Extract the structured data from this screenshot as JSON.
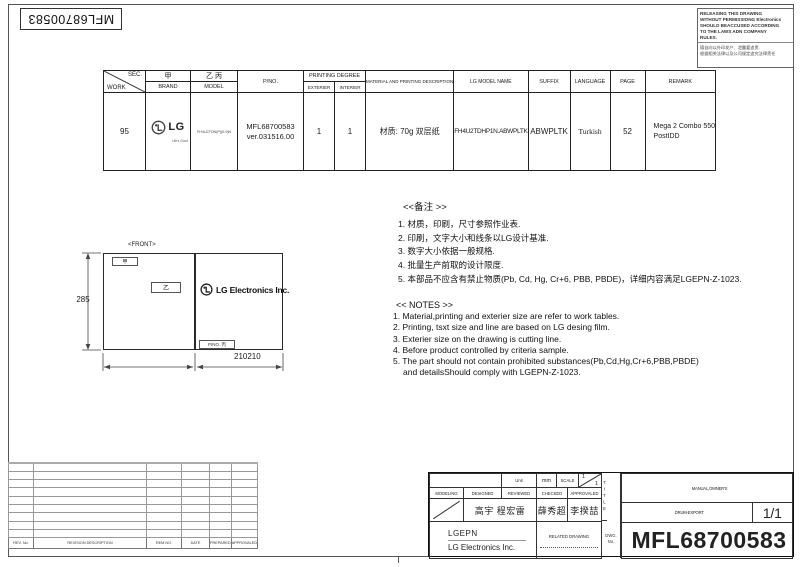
{
  "corner": {
    "rotated_part_no": "MFL68700583"
  },
  "warning": {
    "en1": "RELEASING THIS DRAWING",
    "en2": "WITHOUT PERMISSIONG Electronics",
    "en3": "SHOULD BEACCUSED ACCORDING",
    "en4": "TO THE LAWS ADN COMPANY",
    "en5": "RULES.",
    "cn1": "擅自向以外印发产、泄露要追责.",
    "cn2": "根据相关法律以及公司规定追究法律责任"
  },
  "spec_table": {
    "sec_label": "SEC.",
    "work_label": "WORK",
    "jia": "甲",
    "brand_label": "BRAND",
    "yi_bing": "乙 丙",
    "model_label": "MODEL",
    "pno_label": "P/NO.",
    "printing_degree_label": "PRINTING DEGREE",
    "exterier_label": "EXTERIER",
    "interier_label": "INTERIER",
    "material_label": "MATERIAL AND PRINTING DESCRIPTION",
    "lg_model_label": "LG MODEL NAME",
    "suffix_label": "SUFFIX",
    "language_label": "LANGUAGE",
    "page_label": "PAGE",
    "remark_label": "REMARK",
    "row": {
      "work": "95",
      "brand": "LG",
      "brand_tagline": "Life's Good",
      "model": "FH4U2TDN(P)(0-9)N",
      "pno1": "MFL68700583",
      "pno2": "ver.031516.00",
      "exterier": "1",
      "interier": "1",
      "material": "材质: 70g 双层纸",
      "lg_model_name": "FH4U2TDHP1N.ABWPLTK",
      "suffix": "ABWPLTK",
      "language": "Turkish",
      "page": "52",
      "remark1": "Mega 2  Combo 550",
      "remark2": "PostIDD"
    }
  },
  "drawing": {
    "front_label": "<FRONT>",
    "jia_box": "甲",
    "yi_box": "乙",
    "pno_box": "P/NO. 丙",
    "company": "LG Electronics Inc.",
    "height_dim": "285",
    "width_dim": "210210"
  },
  "notes_cn": {
    "title": "<<备注 >>",
    "items": [
      "1.  材质，印刷，尺寸参照作业表.",
      "2.  印刷，文字大小和线条以LG设计基准.",
      "3.  数字大小依据一般规格.",
      "4.  批量生产前取的设计限度.",
      "5.  本部品不应含有禁止物质(Pb, Cd, Hg, Cr+6, PBB, PBDE)，详细内容满足LGEPN-Z-1023."
    ]
  },
  "notes_en": {
    "title": "<< NOTES >>",
    "items": [
      "1. Material,printing and exterier size are refer to work tables.",
      "2. Printing, tsxt  size and line are based on LG desing film.",
      "3. Exterier size on the drawing is cutting line.",
      "4. Before product controlled by criteria sample.",
      "5. The part should not contain prohibited substances(Pb,Cd,Hg,Cr+6,PBB,PBDE)"
    ],
    "item5_cont": "and detailsShould comply with LGEPN-Z-1023."
  },
  "revision_table": {
    "headers": [
      "REV. No.",
      "REVISION DESCRIPTION",
      "REM.NO.",
      "DATE",
      "PREPARED",
      "APPROVALED"
    ]
  },
  "title_block": {
    "unit_label": "Unit",
    "unit_value": "mm",
    "scale_label": "SCALE",
    "scale_num": "1",
    "scale_den": "1",
    "modeling_label": "MODELING",
    "designed_label": "DESIGNED",
    "reviewed_label": "REVIEWED",
    "checked_label": "CHECKED",
    "approved_label": "APPROVALED",
    "designed_name": "高宇 程宏雷",
    "checked_name": "薛秀超",
    "approved_name": "李揆喆",
    "company_code": "LGEPN",
    "company_name": "LG Electronics Inc.",
    "related_label": "RELATED DRAWING",
    "dwg_label_line1": "DWG.",
    "dwg_label_line2": "No.",
    "title_label": "TITLE",
    "title_line1": "MANUAL,OWNER'S",
    "title_line2": "DRUM-EXPORT",
    "sheet": "1/1",
    "drawing_no": "MFL68700583"
  }
}
